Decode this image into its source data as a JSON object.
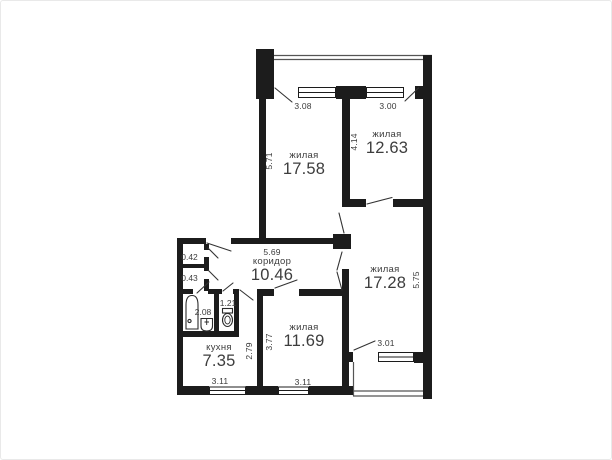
{
  "title": "apartment-floor-plan",
  "colors": {
    "wall": "#1c1c1c",
    "text": "#3d3d3d",
    "background": "#ffffff",
    "rail": "#555555"
  },
  "rooms": {
    "living1": {
      "label": "жилая",
      "area": "17.58"
    },
    "living2": {
      "label": "жилая",
      "area": "12.63"
    },
    "living3": {
      "label": "жилая",
      "area": "17.28"
    },
    "living4": {
      "label": "жилая",
      "area": "11.69"
    },
    "corridor": {
      "label": "коридор",
      "area": "10.46"
    },
    "kitchen": {
      "label": "кухня",
      "area": "7.35"
    },
    "bathroom": {
      "area": "2.08"
    },
    "wc": {
      "area": "1.21"
    },
    "closet_top": {
      "area": "0.42"
    },
    "closet_bottom": {
      "area": "0.43"
    }
  },
  "dimensions": {
    "living1_width": "3.08",
    "living1_height": "5.71",
    "living2_width": "3.00",
    "living2_height": "4.14",
    "living3_width": "3.01",
    "living3_height": "5.75",
    "living4_width": "3.11",
    "living4_height": "3.77",
    "corridor_width": "5.69",
    "kitchen_width": "3.11",
    "kitchen_height": "2.79"
  }
}
